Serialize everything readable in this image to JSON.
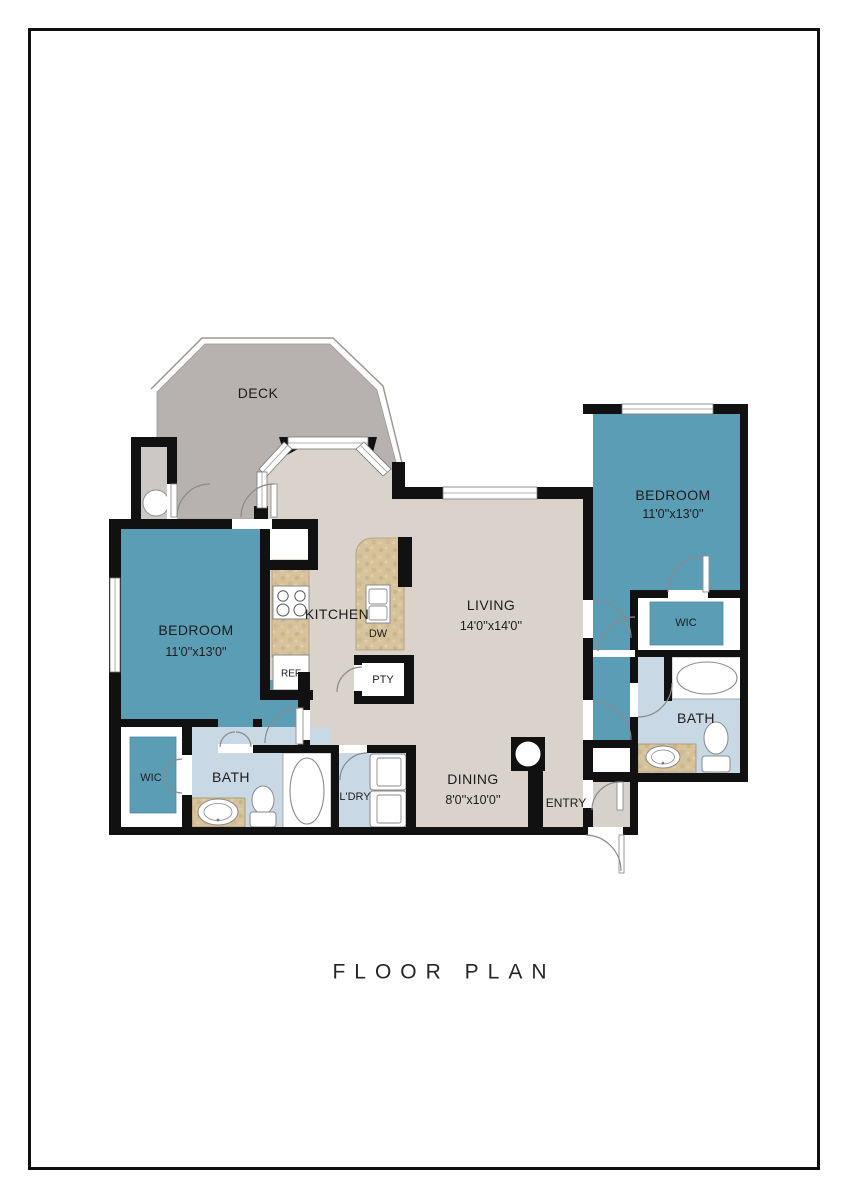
{
  "title": {
    "text": "FLOOR PLAN"
  },
  "colors": {
    "wall": "#111111",
    "bedroom_blue": "#5C9DB6",
    "bath_blue": "#C9D8E5",
    "floor_gray": "#D9D3CC",
    "deck_gray": "#B7B2AF",
    "storage_gray": "#CCC8C5",
    "counter_tan": "#D6C39C",
    "outline_gray": "#9B9793"
  },
  "labels": {
    "deck": {
      "text": "DECK"
    },
    "bedroom1": {
      "text": "BEDROOM"
    },
    "bedroom1_dims": {
      "text": "11'0''x13'0''"
    },
    "kitchen": {
      "text": "KITCHEN"
    },
    "ref": {
      "text": "REF"
    },
    "dw": {
      "text": "DW"
    },
    "pty": {
      "text": "PTY"
    },
    "living": {
      "text": "LIVING"
    },
    "living_dims": {
      "text": "14'0''x14'0''"
    },
    "bedroom2": {
      "text": "BEDROOM"
    },
    "bedroom2_dims": {
      "text": "11'0''x13'0''"
    },
    "wic2": {
      "text": "WIC"
    },
    "bath2": {
      "text": "BATH"
    },
    "wic1": {
      "text": "WIC"
    },
    "bath1": {
      "text": "BATH"
    },
    "laundry": {
      "text": "L'DRY"
    },
    "dining": {
      "text": "DINING"
    },
    "dining_dims": {
      "text": "8'0''x10'0''"
    },
    "entry": {
      "text": "ENTRY"
    }
  },
  "rooms": [
    {
      "name": "deck",
      "label": "DECK"
    },
    {
      "name": "bedroom-left",
      "label": "BEDROOM",
      "dims": "11'0''x13'0''"
    },
    {
      "name": "kitchen",
      "label": "KITCHEN"
    },
    {
      "name": "living",
      "label": "LIVING",
      "dims": "14'0''x14'0''"
    },
    {
      "name": "dining",
      "label": "DINING",
      "dims": "8'0''x10'0''"
    },
    {
      "name": "entry",
      "label": "ENTRY"
    },
    {
      "name": "laundry",
      "label": "L'DRY"
    },
    {
      "name": "bath-left",
      "label": "BATH"
    },
    {
      "name": "wic-left",
      "label": "WIC"
    },
    {
      "name": "bedroom-right",
      "label": "BEDROOM",
      "dims": "11'0''x13'0''"
    },
    {
      "name": "wic-right",
      "label": "WIC"
    },
    {
      "name": "bath-right",
      "label": "BATH"
    }
  ]
}
